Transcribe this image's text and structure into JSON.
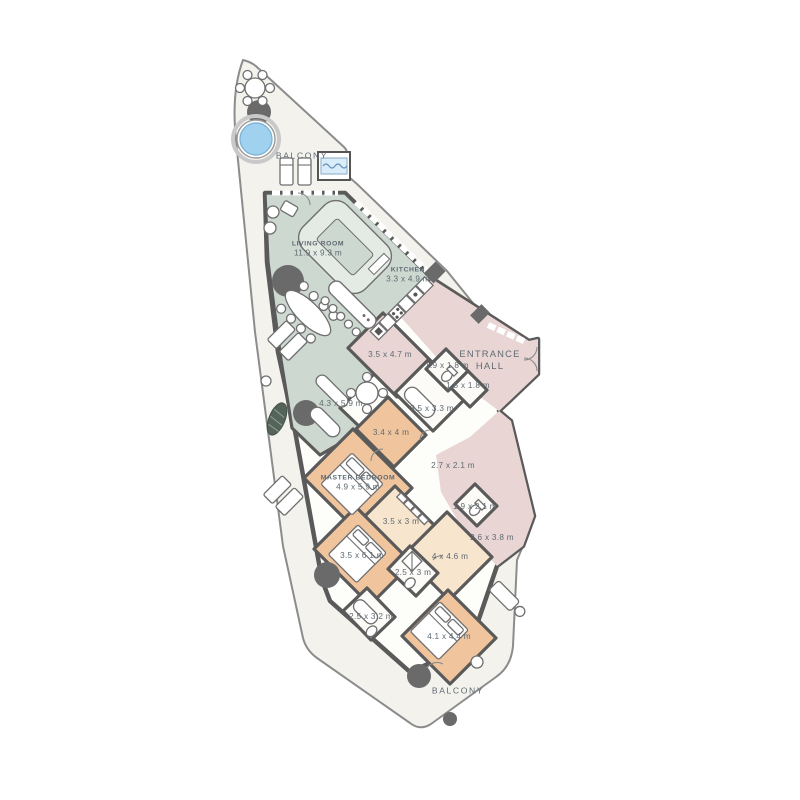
{
  "floorplan": {
    "type": "apartment-floor-plan",
    "colors": {
      "balcony_floor": "#f3f2ed",
      "living_zone": "#cdd8d0",
      "hall_zone": "#e9d6d4",
      "bedroom_zone": "#f0c59d",
      "bedroom_zone_light": "#f8e5cd",
      "wall": "#5a5a5a",
      "pool_water": "#a0d2f0",
      "label_text": "#5f6a72"
    },
    "labels": [
      {
        "id": "balcony-top",
        "name": "BALCONY",
        "dims": "",
        "x": 302,
        "y": 156
      },
      {
        "id": "living-room",
        "name": "LIVING ROOM",
        "dims": "11.9 x 9.3 m",
        "x": 318,
        "y": 250
      },
      {
        "id": "kitchen",
        "name": "KITCHEN",
        "dims": "3.3 x 4.9 m",
        "x": 408,
        "y": 276
      },
      {
        "id": "utility",
        "name": "",
        "dims": "3.5 x 4.7 m",
        "x": 390,
        "y": 355
      },
      {
        "id": "wc-1",
        "name": "",
        "dims": "1.9 x 1.8 m",
        "x": 447,
        "y": 366
      },
      {
        "id": "entrance-hall",
        "name": "ENTRANCE HALL",
        "dims": "",
        "x": 490,
        "y": 360
      },
      {
        "id": "closet-1",
        "name": "",
        "dims": "1.5 x 1.8 m",
        "x": 468,
        "y": 386
      },
      {
        "id": "bathroom-1",
        "name": "",
        "dims": "3.5 x 3.3 m",
        "x": 432,
        "y": 409
      },
      {
        "id": "study",
        "name": "",
        "dims": "4.3 x 5.9 m",
        "x": 341,
        "y": 404
      },
      {
        "id": "dressing",
        "name": "",
        "dims": "3.4 x 4 m",
        "x": 391,
        "y": 433
      },
      {
        "id": "corridor-1",
        "name": "",
        "dims": "2.7 x 2.1 m",
        "x": 453,
        "y": 466
      },
      {
        "id": "master-bedroom",
        "name": "MASTER BEDROOM",
        "dims": "4.9 x 5.9 m",
        "x": 358,
        "y": 484
      },
      {
        "id": "wc-2",
        "name": "",
        "dims": "1.9 x 2.1 m",
        "x": 475,
        "y": 507
      },
      {
        "id": "closet-2",
        "name": "",
        "dims": "3.5 x 3 m",
        "x": 401,
        "y": 522
      },
      {
        "id": "hall-2",
        "name": "",
        "dims": "2.6 x 3.8 m",
        "x": 492,
        "y": 538
      },
      {
        "id": "bedroom-2",
        "name": "",
        "dims": "3.5 x 6.1 m",
        "x": 362,
        "y": 556
      },
      {
        "id": "bedroom-3",
        "name": "",
        "dims": "4 x 4.6 m",
        "x": 450,
        "y": 557
      },
      {
        "id": "bathroom-2",
        "name": "",
        "dims": "2.5 x 3 m",
        "x": 413,
        "y": 573
      },
      {
        "id": "bathroom-3",
        "name": "",
        "dims": "2.5 x 3.2 m",
        "x": 371,
        "y": 617
      },
      {
        "id": "bedroom-4",
        "name": "",
        "dims": "4.1 x 4.4 m",
        "x": 449,
        "y": 637
      },
      {
        "id": "balcony-bottom",
        "name": "BALCONY",
        "dims": "",
        "x": 458,
        "y": 691
      }
    ]
  }
}
